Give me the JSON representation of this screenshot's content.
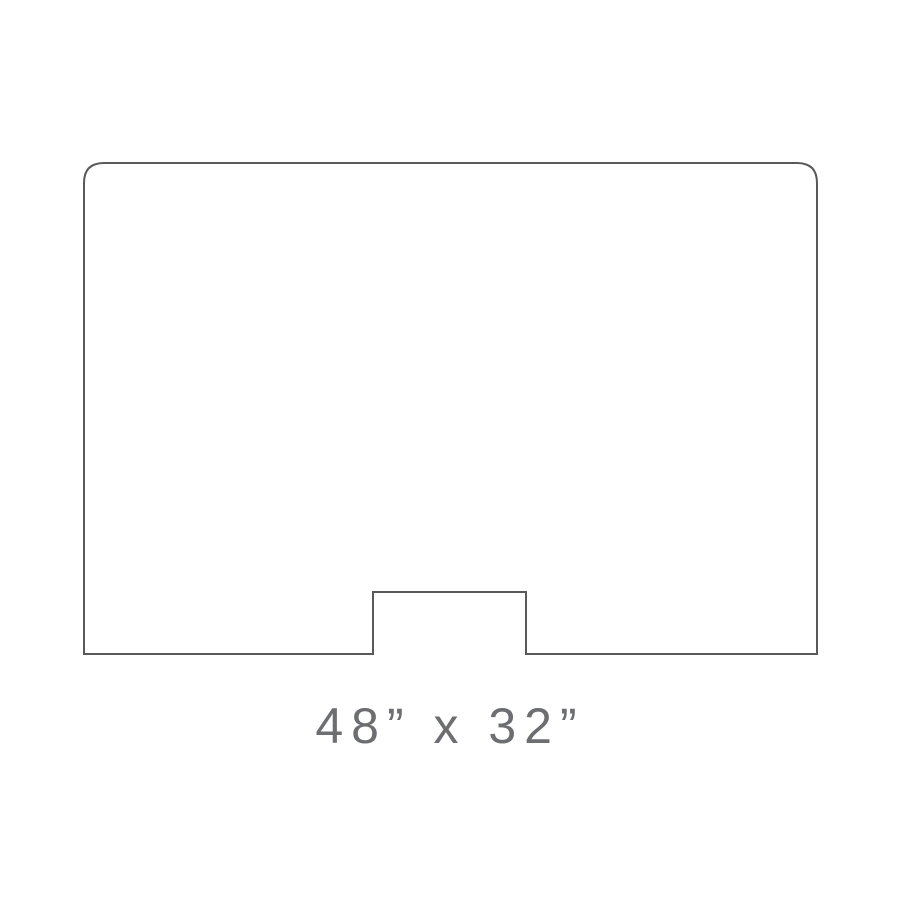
{
  "diagram": {
    "description": "Line drawing of a rectangular panel with rounded top corners and a rectangular pass-through notch cut out of the center of the bottom edge",
    "dimension_label": "48” x 32”",
    "outline_path": "M 84 654 L 84 183 Q 84 163 104 163 L 797 163 Q 817 163 817 183 L 817 654 L 526 654 L 526 592 L 373 592 L 373 654 Z"
  },
  "colors": {
    "outline": "#58595b",
    "label": "#6d6e71",
    "background": "#ffffff"
  }
}
